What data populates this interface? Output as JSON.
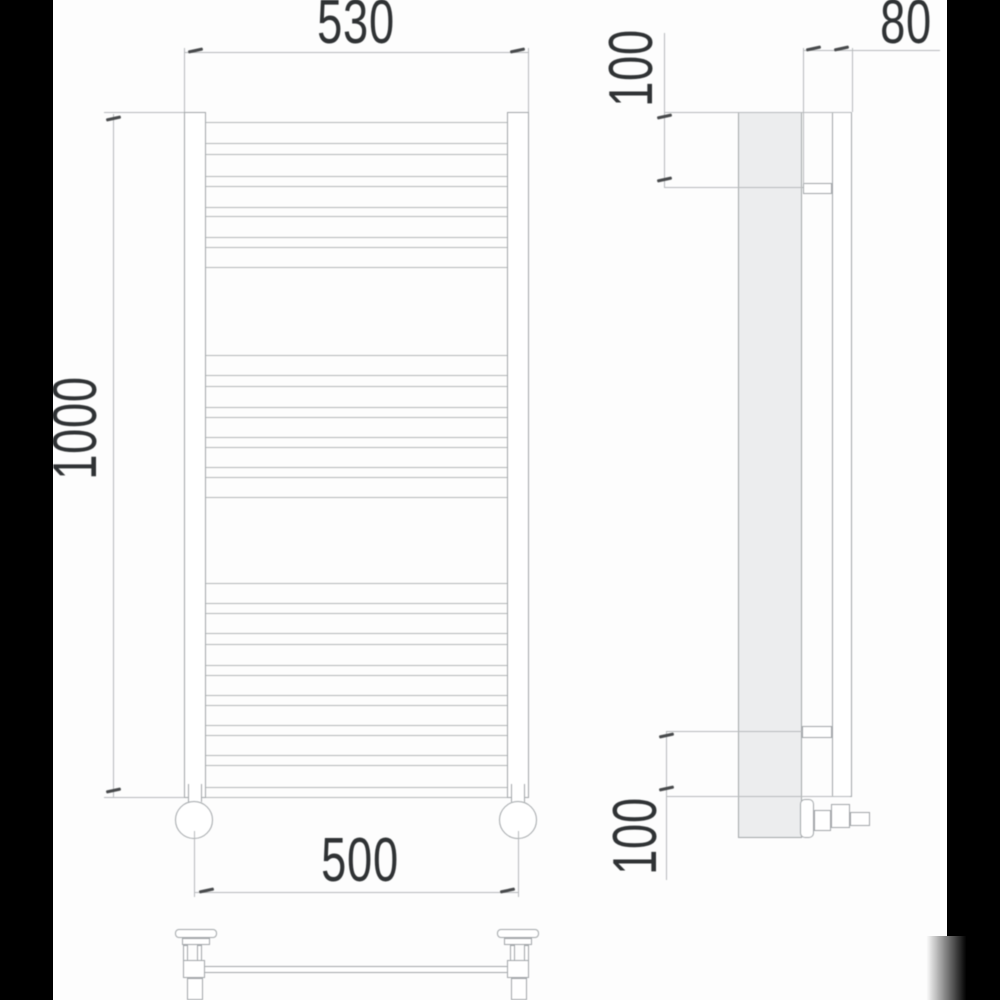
{
  "drawing": {
    "type": "technical-drawing",
    "subject": "ladder towel radiator - front, side and bottom orthographic views",
    "dimensions": {
      "top_width": "530",
      "overall_height": "1000",
      "bottom_connection_width": "500",
      "side_top_offset": "100",
      "side_depth": "80",
      "side_bottom_offset": "100"
    }
  },
  "colors": {
    "background": "#fdfdfd",
    "letterbox_bar": "#000000",
    "line_dark": "#a2a6a9",
    "line_light": "#b4b7ba",
    "line_dim": "#b7babc",
    "tick": "#47494b",
    "text": "#2f3234",
    "panel_fill": "#ecedee",
    "nut": "#55585a"
  },
  "front_view": {
    "rung_field": {
      "left": 206,
      "width": 301
    },
    "rung_lines": {
      "top": [
        122,
        143,
        154,
        176,
        186,
        207,
        216,
        237,
        247,
        267
      ],
      "middle": [
        355,
        375,
        386,
        407,
        417,
        437,
        447,
        467,
        477,
        497
      ],
      "bottom": [
        583,
        603,
        613,
        633,
        644,
        665,
        675,
        695,
        705,
        725,
        735,
        755,
        765,
        787,
        797
      ]
    }
  }
}
